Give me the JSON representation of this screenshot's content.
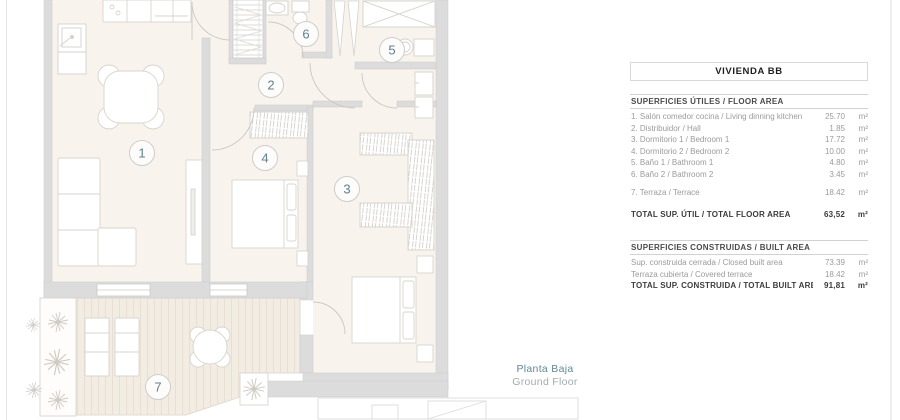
{
  "panel": {
    "title": "VIVIENDA BB",
    "sections": [
      {
        "header": "SUPERFICIES ÚTILES / FLOOR AREA",
        "rows": [
          {
            "label": "1. Salón comedor cocina / Living dinning kitchen",
            "value": "25.70",
            "unit": "m²"
          },
          {
            "label": "2. Distribuidor / Hall",
            "value": "1.85",
            "unit": "m²"
          },
          {
            "label": "3. Dormitorio 1 / Bedroom 1",
            "value": "17.72",
            "unit": "m²"
          },
          {
            "label": "4. Dormitorio 2 / Bedroom 2",
            "value": "10.00",
            "unit": "m²"
          },
          {
            "label": "5. Baño 1 / Bathroom 1",
            "value": "4.80",
            "unit": "m²"
          },
          {
            "label": "6. Baño 2 / Bathroom 2",
            "value": "3.45",
            "unit": "m²"
          },
          {
            "label": "7. Terraza / Terrace",
            "value": "18.42",
            "unit": "m²",
            "gap_before": true
          }
        ],
        "total": {
          "label": "TOTAL SUP. ÚTIL / TOTAL FLOOR AREA",
          "value": "63,52",
          "unit": "m²"
        },
        "total_gap": true
      },
      {
        "header": "SUPERFICIES CONSTRUIDAS / BUILT AREA",
        "rows": [
          {
            "label": "Sup. construida cerrada / Closed built area",
            "value": "73.39",
            "unit": "m²"
          },
          {
            "label": "Terraza cubierta / Covered terrace",
            "value": "18.42",
            "unit": "m²"
          }
        ],
        "total": {
          "label": "TOTAL SUP. CONSTRUIDA / TOTAL BUILT AREA",
          "value": "91,81",
          "unit": "m²"
        },
        "total_gap": false
      }
    ]
  },
  "plan": {
    "rooms": [
      "1",
      "2",
      "3",
      "4",
      "5",
      "6",
      "7"
    ],
    "floor_label_es": "Planta Baja",
    "floor_label_en": "Ground Floor"
  },
  "colors": {
    "accent_teal": "#5d8191",
    "wall_gray": "#dcdcdc",
    "floor_beige": "#f8f3ed",
    "terrace_beige": "#f3ece2",
    "text_gray": "#9b9b9b",
    "text_dark": "#3c3c3c",
    "line_gray": "#d5d5d5"
  }
}
